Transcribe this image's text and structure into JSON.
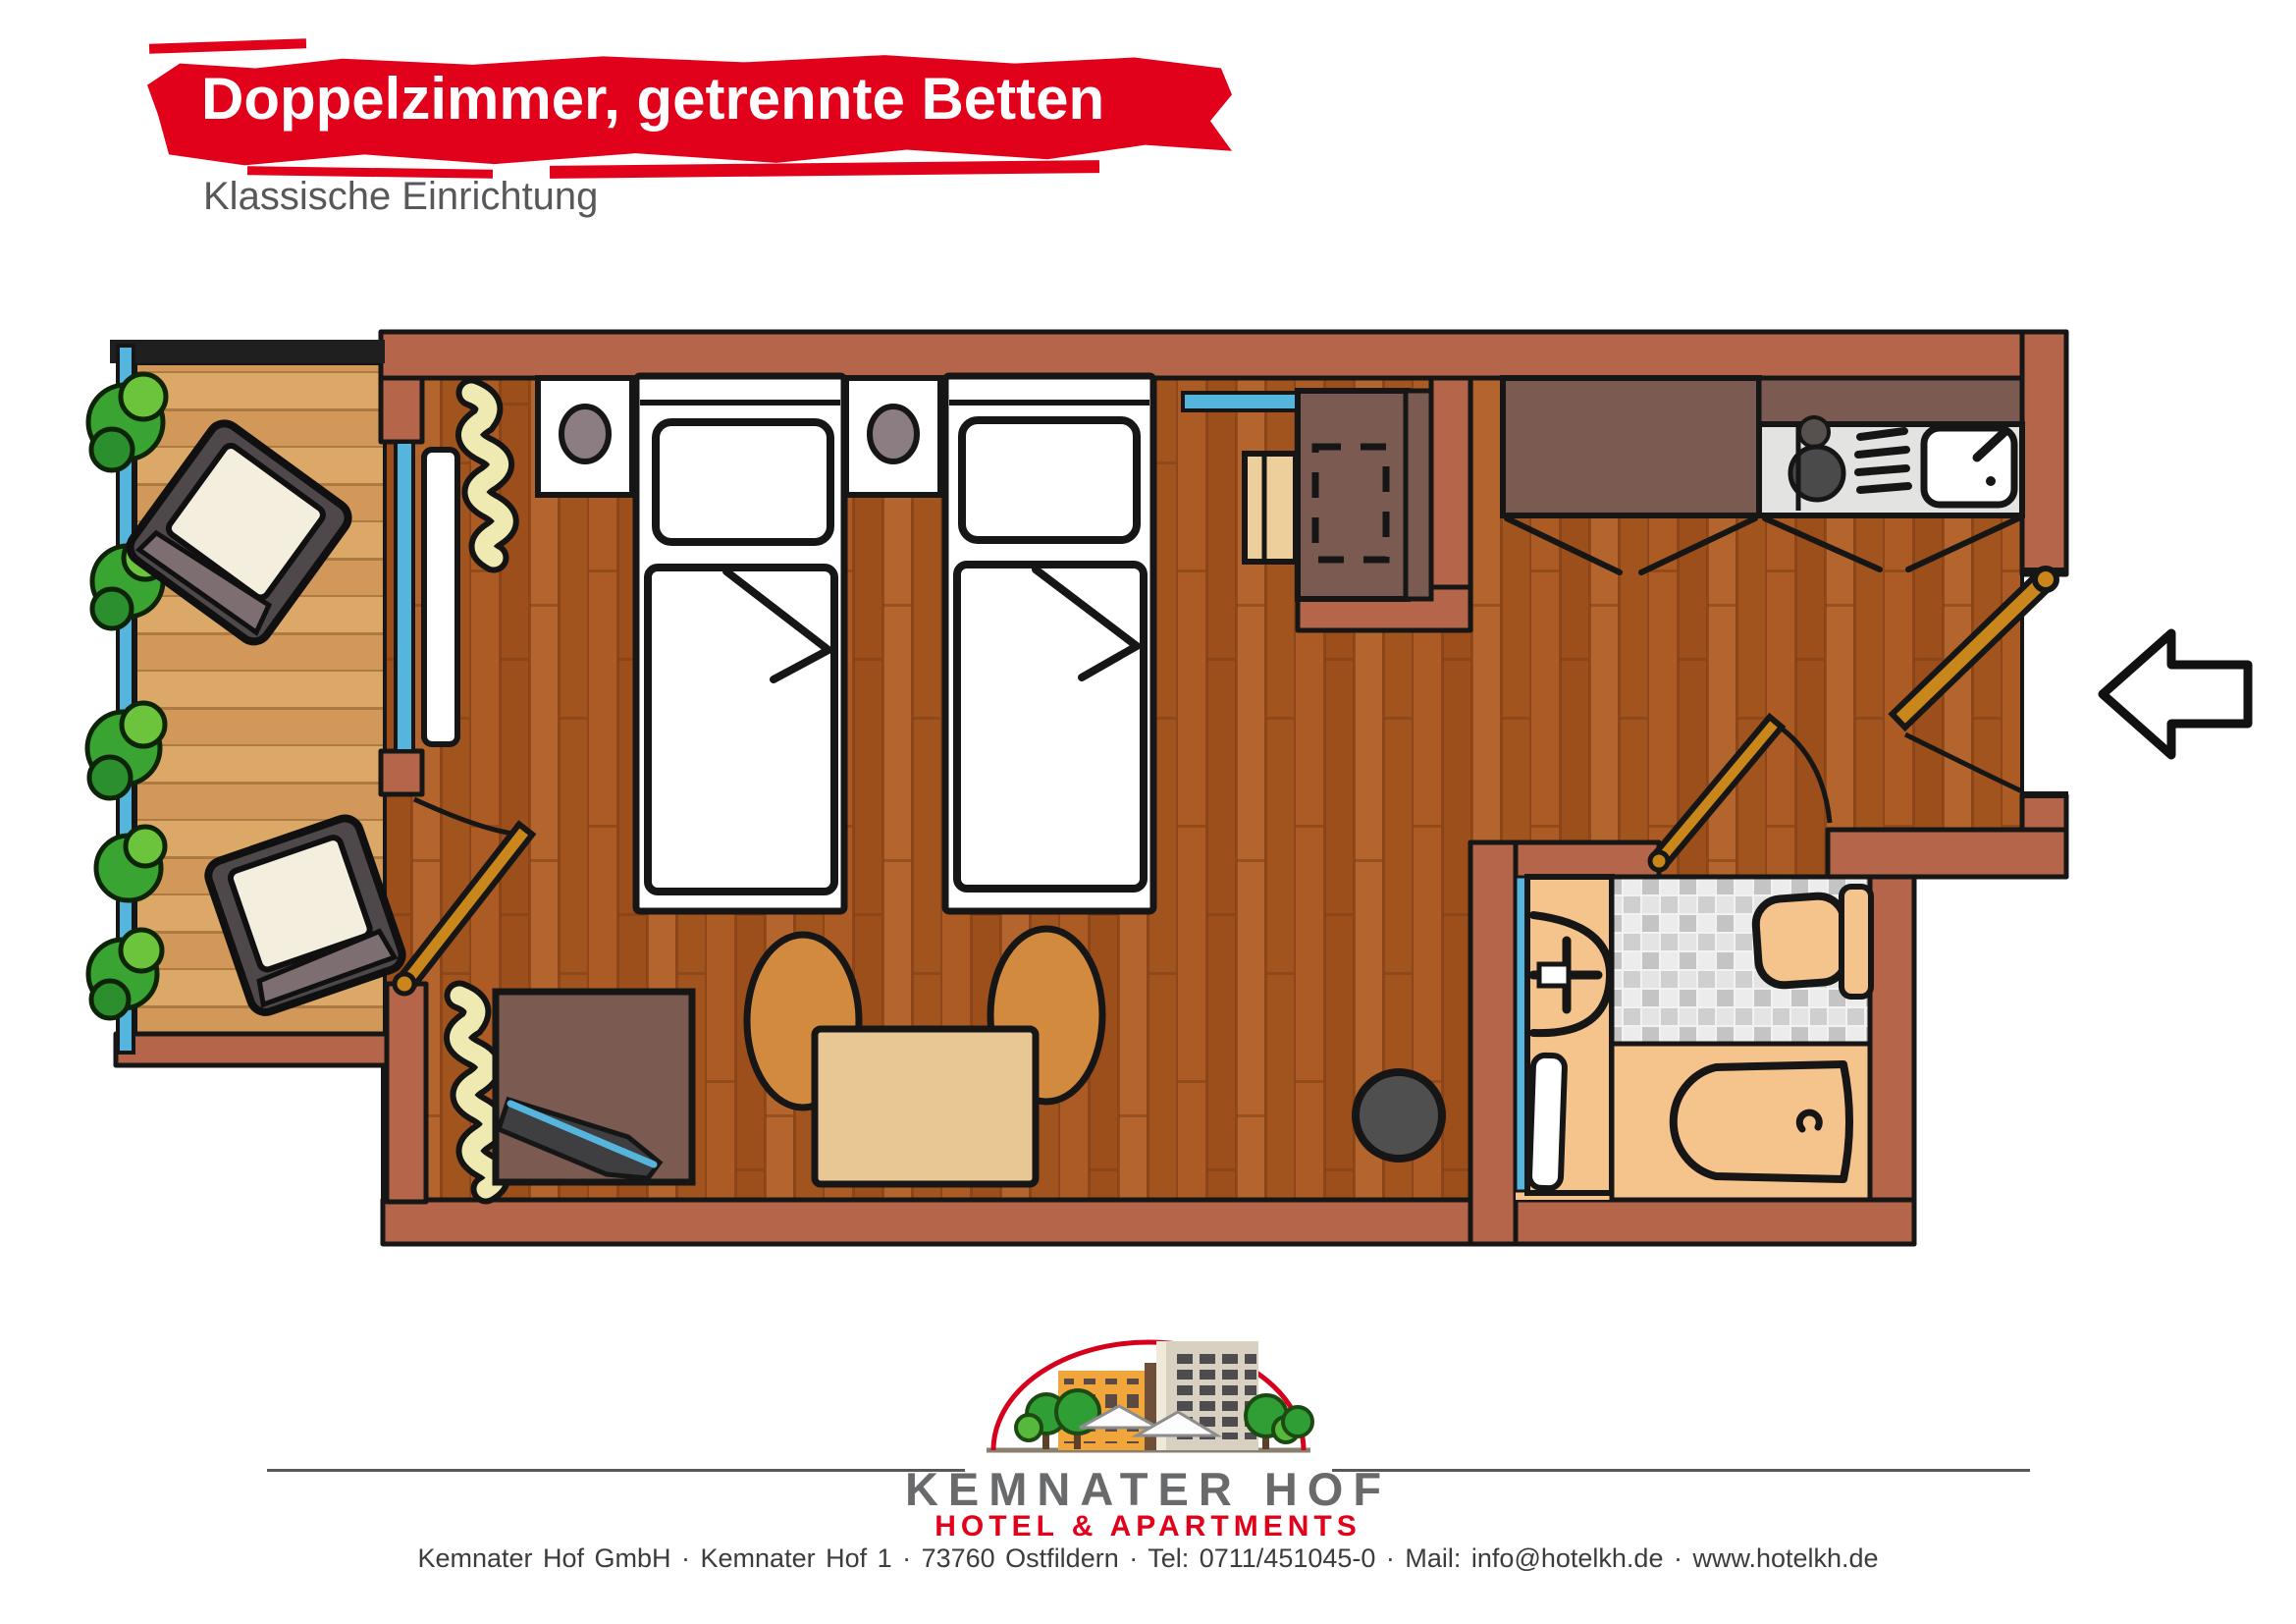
{
  "header": {
    "title": "Doppelzimmer, getrennte Betten",
    "subtitle": "Klassische Einrichtung",
    "accent_color": "#e2011b",
    "subtitle_color": "#57585a"
  },
  "floorplan": {
    "rooms": [
      "balcony",
      "bedroom-living-room",
      "kitchenette",
      "hallway",
      "bathroom"
    ],
    "furniture": [
      "balcony-chair",
      "balcony-chair",
      "railing-plants",
      "single-bed",
      "single-bed",
      "nightstand",
      "nightstand",
      "radiator",
      "plant",
      "plant",
      "desk",
      "desk-chair",
      "kitchen-cabinet",
      "stove",
      "kitchen-sink",
      "sideboard",
      "tv",
      "dining-table",
      "dining-chair",
      "dining-chair",
      "waste-bin",
      "washbasin",
      "towel-radiator",
      "toilet",
      "bathtub",
      "entrance-door",
      "bathroom-door",
      "balcony-door",
      "entrance-arrow"
    ],
    "colors": {
      "wall": "#b5654a",
      "outline": "#161616",
      "room_floor": "#a4561f",
      "balcony_floor": "#d79f62",
      "window_glass": "#55b5dd",
      "door_wood": "#c8861b",
      "furniture_brown": "#7b5a51",
      "counter_gray": "#e3e3e2",
      "bathroom_peach": "#f5c38c",
      "plant_green": "#2f9e35",
      "plant_pale": "#efeab2",
      "chair_orange": "#d28a3e",
      "table_tan": "#e9c795",
      "lamp_gray": "#8b7d82"
    }
  },
  "logo": {
    "name": "KEMNATER HOF",
    "tagline": "HOTEL & APARTMENTS",
    "name_color": "#696a6c",
    "tagline_color": "#e2011b",
    "arc_color": "#d6001c"
  },
  "footer": {
    "items": [
      "Kemnater Hof GmbH",
      "Kemnater Hof 1",
      "73760 Ostfildern",
      "Tel: 0711/451045-0",
      "Mail: info@hotelkh.de",
      "www.hotelkh.de"
    ],
    "separator": "·",
    "contact_line": "Kemnater Hof GmbH  ·  Kemnater Hof 1  ·  73760 Ostfildern  ·  Tel: 0711/451045-0  ·  Mail: info@hotelkh.de  ·  www.hotelkh.de"
  }
}
